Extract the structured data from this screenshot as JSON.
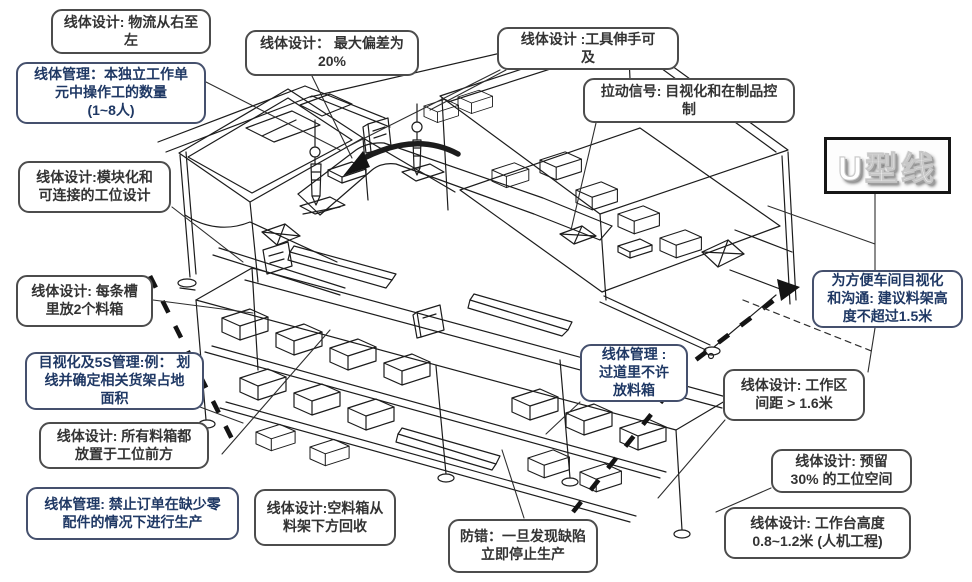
{
  "diagram": {
    "title": "U型线",
    "callouts": [
      {
        "name": "flow-direction",
        "color": "black",
        "text": "线体设计: 物流从右至\n左"
      },
      {
        "name": "operator-count",
        "color": "blue",
        "text": "线体管理：本独立工作单\n元中操作工的数量\n(1~8人)"
      },
      {
        "name": "modular-stations",
        "color": "black",
        "text": "线体设计:模块化和\n可连接的工位设计"
      },
      {
        "name": "max-deviation",
        "color": "black",
        "text": "线体设计： 最大偏差为\n20%"
      },
      {
        "name": "tools-within-reach",
        "color": "black",
        "text": "线体设计 :工具伸手可\n及"
      },
      {
        "name": "pull-signal",
        "color": "black",
        "text": "拉动信号: 目视化和在制品控\n制"
      },
      {
        "name": "two-bins-per-slot",
        "color": "black",
        "text": "线体设计: 每条槽\n里放2个料箱"
      },
      {
        "name": "5s-floor-marking",
        "color": "blue",
        "text": "目视化及5S管理:例： 划\n线并确定相关货架占地\n面积"
      },
      {
        "name": "bins-in-front",
        "color": "black",
        "text": "线体设计: 所有料箱都\n放置于工位前方"
      },
      {
        "name": "no-missing-parts",
        "color": "blue",
        "text": "线体管理: 禁止订单在缺少零\n配件的情况下进行生产"
      },
      {
        "name": "empty-bin-return",
        "color": "black",
        "text": "线体设计:空料箱从\n料架下方回收"
      },
      {
        "name": "stop-on-defect",
        "color": "black",
        "text": "防错：一旦发现缺陷\n立即停止生产"
      },
      {
        "name": "no-bins-in-aisle",
        "color": "blue",
        "text": "线体管理 :\n过道里不许\n放料箱"
      },
      {
        "name": "rack-height-limit",
        "color": "blue",
        "text": "为方便车间目视化\n和沟通: 建议料架高\n度不超过1.5米"
      },
      {
        "name": "workzone-spacing",
        "color": "black",
        "text": "线体设计: 工作区\n间距 > 1.6米"
      },
      {
        "name": "reserve-station-space",
        "color": "black",
        "text": "线体设计: 预留\n30% 的工位空间"
      },
      {
        "name": "bench-height",
        "color": "black",
        "text": "线体设计: 工作台高度\n0.8~1.2米 (人机工程)"
      }
    ],
    "colors": {
      "blue_text": "#1f3864",
      "black_text": "#333333",
      "box_border": "#4c4c4c"
    }
  }
}
